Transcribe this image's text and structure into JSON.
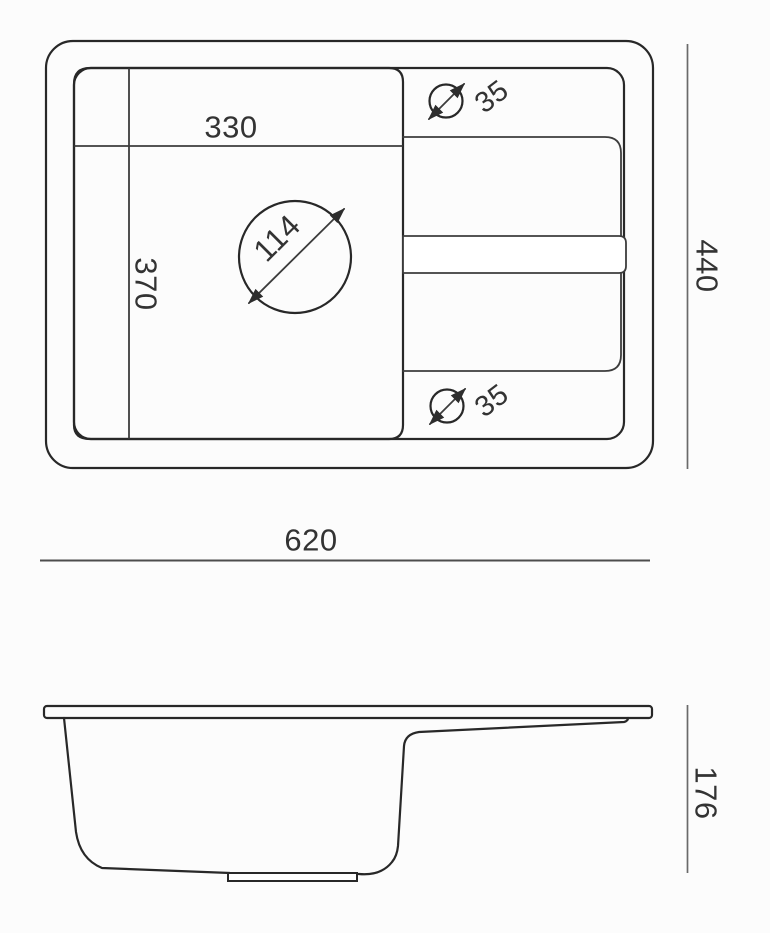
{
  "drawing": {
    "type": "technical-dimension-drawing",
    "subject": "kitchen sink with drainboard, top view and side view",
    "units_shown": "mm (implied, unlabeled)",
    "line_color": "#282828",
    "dimension_line_color": "#6a6a6a",
    "text_color": "#333333",
    "background_color": "#fcfcfc"
  },
  "top_view": {
    "bowl_width_label": "330",
    "bowl_depth_label": "370",
    "drain_hole_diameter_label": "114",
    "faucet_hole_top_diameter_label": "35",
    "faucet_hole_bottom_diameter_label": "35",
    "overall_depth_label": "440",
    "overall_width_label": "620"
  },
  "side_view": {
    "overall_height_label": "176"
  }
}
